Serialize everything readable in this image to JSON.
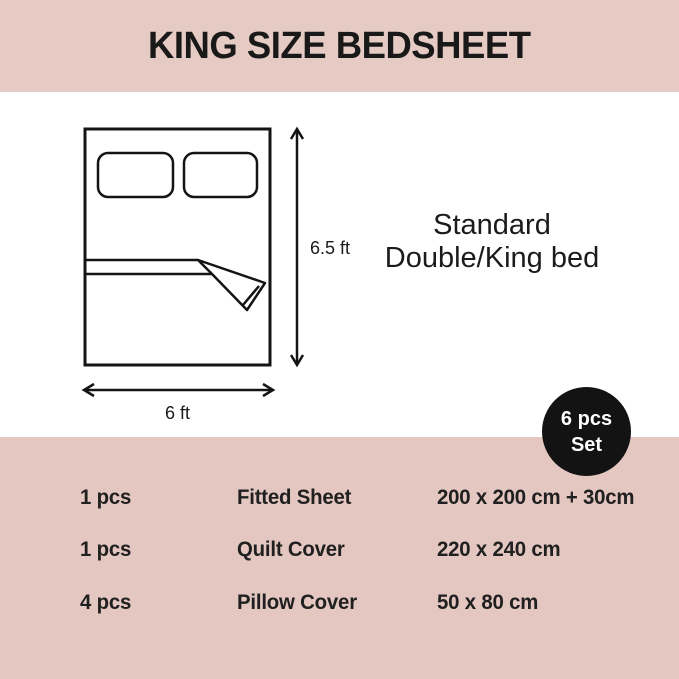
{
  "header": {
    "title": "KING SIZE BEDSHEET",
    "bg_color": "#e6cbc4"
  },
  "diagram": {
    "height_label": "6.5 ft",
    "width_label": "6 ft",
    "bed_type": {
      "line1": "Standard",
      "line2": "Double/King bed"
    }
  },
  "badge": {
    "line1": "6 pcs",
    "line2": "Set",
    "bg_color": "#131313",
    "text_color": "#ffffff"
  },
  "set_table": {
    "bg_color": "#e4c7c0",
    "rows": [
      {
        "qty": "1 pcs",
        "item": "Fitted Sheet",
        "size": "200 x 200 cm + 30cm"
      },
      {
        "qty": "1 pcs",
        "item": "Quilt Cover",
        "size": "220 x 240 cm"
      },
      {
        "qty": "4 pcs",
        "item": "Pillow Cover",
        "size": "50 x 80 cm"
      }
    ]
  }
}
